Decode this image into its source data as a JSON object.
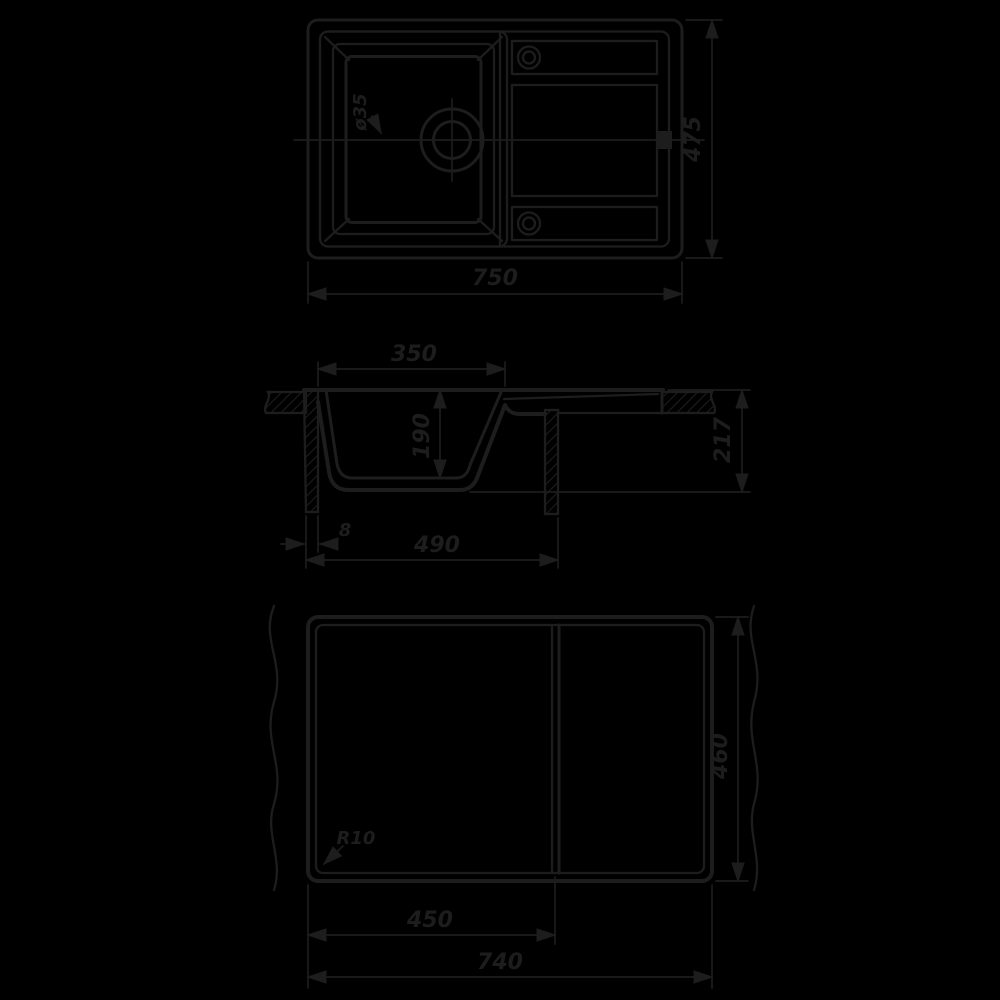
{
  "title": "kitchen-sink-technical-drawing",
  "colors": {
    "background": "#000000",
    "line": "#1d1d1d"
  },
  "views": {
    "top": {
      "width_label": "750",
      "depth_label": "475",
      "drain_label": "ø35"
    },
    "section": {
      "opening_width_label": "350",
      "bowl_depth_label": "190",
      "overall_height_label": "217",
      "bottom_width_label": "490",
      "edge_offset_label": "8"
    },
    "bottom": {
      "corner_radius_label": "R10",
      "bowl_section_width_label": "450",
      "base_width_label": "740",
      "base_depth_label": "460"
    }
  }
}
